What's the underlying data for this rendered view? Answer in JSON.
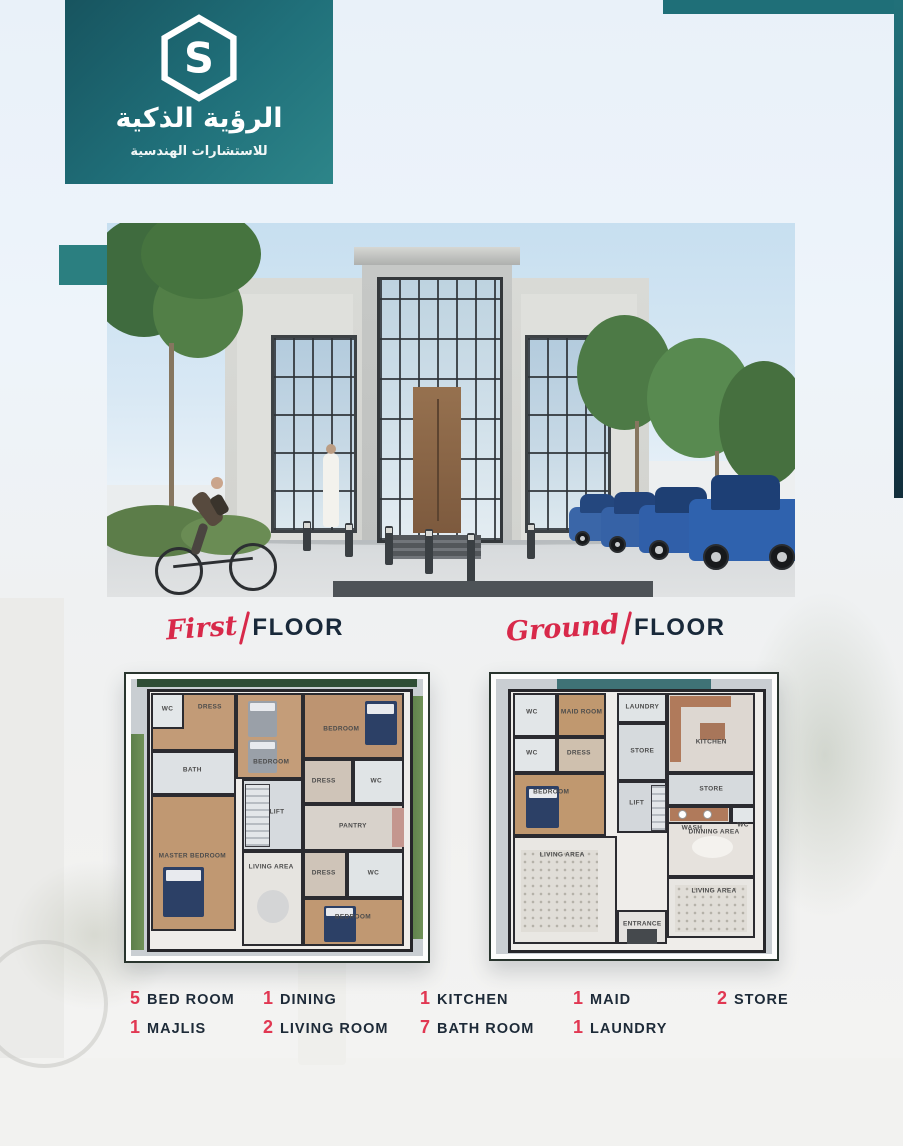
{
  "brand": {
    "monogram": "S",
    "title": "الرؤية الذكية",
    "subtitle": "للاستشارات الهندسية",
    "teal": "#20707a",
    "teal_dark": "#122e3b"
  },
  "headings": {
    "first": {
      "script": "First",
      "rest": "FLOOR"
    },
    "ground": {
      "script": "Ground",
      "rest": "FLOOR"
    }
  },
  "plans": {
    "first": {
      "rooms": [
        "WC",
        "DRESS",
        "BATH",
        "BEDROOM",
        "BEDROOM",
        "DRESS",
        "WC",
        "LIFT",
        "PANTRY",
        "DRESS",
        "WC",
        "MASTER BEDROOM",
        "LIVING AREA",
        "BEDROOM"
      ]
    },
    "ground": {
      "rooms": [
        "WC",
        "MAID ROOM",
        "LAUNDRY",
        "KITCHEN",
        "WC",
        "DRESS",
        "STORE",
        "BEDROOM",
        "STORE",
        "LIFT",
        "WASH",
        "WC",
        "LIVING AREA",
        "DINNING AREA",
        "LIVING AREA",
        "ENTRANCE"
      ]
    }
  },
  "stats": [
    {
      "count": "5",
      "label": "BED ROOM"
    },
    {
      "count": "1",
      "label": "DINING"
    },
    {
      "count": "1",
      "label": "KITCHEN"
    },
    {
      "count": "1",
      "label": "MAID"
    },
    {
      "count": "2",
      "label": "STORE"
    },
    {
      "count": "1",
      "label": "MAJLIS"
    },
    {
      "count": "2",
      "label": "LIVING ROOM"
    },
    {
      "count": "7",
      "label": "BATH ROOM"
    },
    {
      "count": "1",
      "label": "LAUNDRY"
    }
  ],
  "colors": {
    "accent_red": "#d8294a",
    "navy": "#1d2a38",
    "sky": "#c7dff0"
  }
}
